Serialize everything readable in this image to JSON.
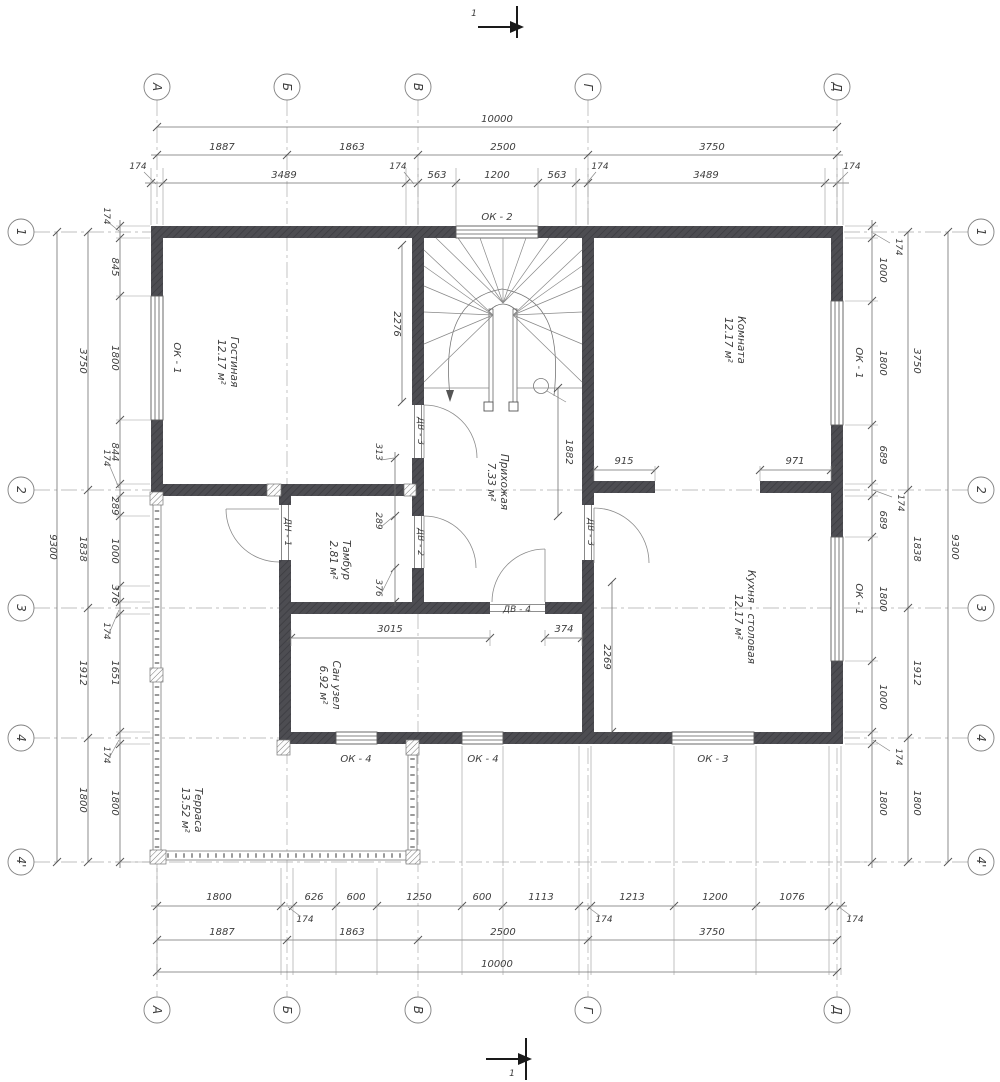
{
  "drawing": {
    "axes_letters": [
      "А",
      "Б",
      "В",
      "Г",
      "Д"
    ],
    "axes_numbers": [
      "1",
      "2",
      "3",
      "4",
      "4'"
    ],
    "section_mark": "1"
  },
  "rooms": [
    {
      "name": "Гостиная",
      "area": "12.17 м²"
    },
    {
      "name": "Комната",
      "area": "12.17 м²"
    },
    {
      "name": "Прихожая",
      "area": "7.33 м²"
    },
    {
      "name": "Тамбур",
      "area": "2.81 м²"
    },
    {
      "name": "Кухня - столовая",
      "area": "12.17 м²"
    },
    {
      "name": "Сан узел",
      "area": "6.92 м²"
    },
    {
      "name": "Терраса",
      "area": "13.52 м²"
    }
  ],
  "openings": {
    "windows": {
      "ok2": "ОК - 2",
      "ok1_left": "ОК - 1",
      "ok1_right_top": "ОК - 1",
      "ok1_right_bottom": "ОК - 1",
      "ok4_a": "ОК - 4",
      "ok4_b": "ОК - 4",
      "ok3": "ОК - 3"
    },
    "doors": {
      "dv3_hall": "ДВ - 3",
      "dv2": "ДВ - 2",
      "dv3_kitchen": "ДВ - 3",
      "dv4": "ДВ - 4",
      "dn1": "ДН - 1"
    }
  },
  "dims": {
    "offset": "174",
    "top": {
      "overall": "10000",
      "axes": [
        "1887",
        "1863",
        "2500",
        "3750"
      ],
      "detail": [
        "3489",
        "563",
        "1200",
        "563",
        "3489"
      ]
    },
    "bottom": {
      "overall": "10000",
      "axes": [
        "1887",
        "1863",
        "2500",
        "3750"
      ],
      "detail": [
        "1800",
        "626",
        "600",
        "1250",
        "600",
        "1113",
        "1213",
        "1200",
        "1076"
      ]
    },
    "left": {
      "overall": "9300",
      "axes": [
        "3750",
        "1838",
        "1912",
        "1800"
      ],
      "detail": [
        "845",
        "1800",
        "844",
        "289",
        "1000",
        "376",
        "1651",
        "1800"
      ]
    },
    "right": {
      "overall": "9300",
      "axes": [
        "3750",
        "1838",
        "1912",
        "1800"
      ],
      "detail": [
        "1000",
        "1800",
        "689",
        "689",
        "1800",
        "1000",
        "1800"
      ]
    },
    "interior": {
      "stair_width": "2276",
      "hall_depth": "1882",
      "kitchen_depth": "2269",
      "room_left": "915",
      "room_right": "971",
      "san_width": "3015",
      "door_offset": "374",
      "wall_segments": [
        "313",
        "289",
        "376"
      ]
    }
  }
}
